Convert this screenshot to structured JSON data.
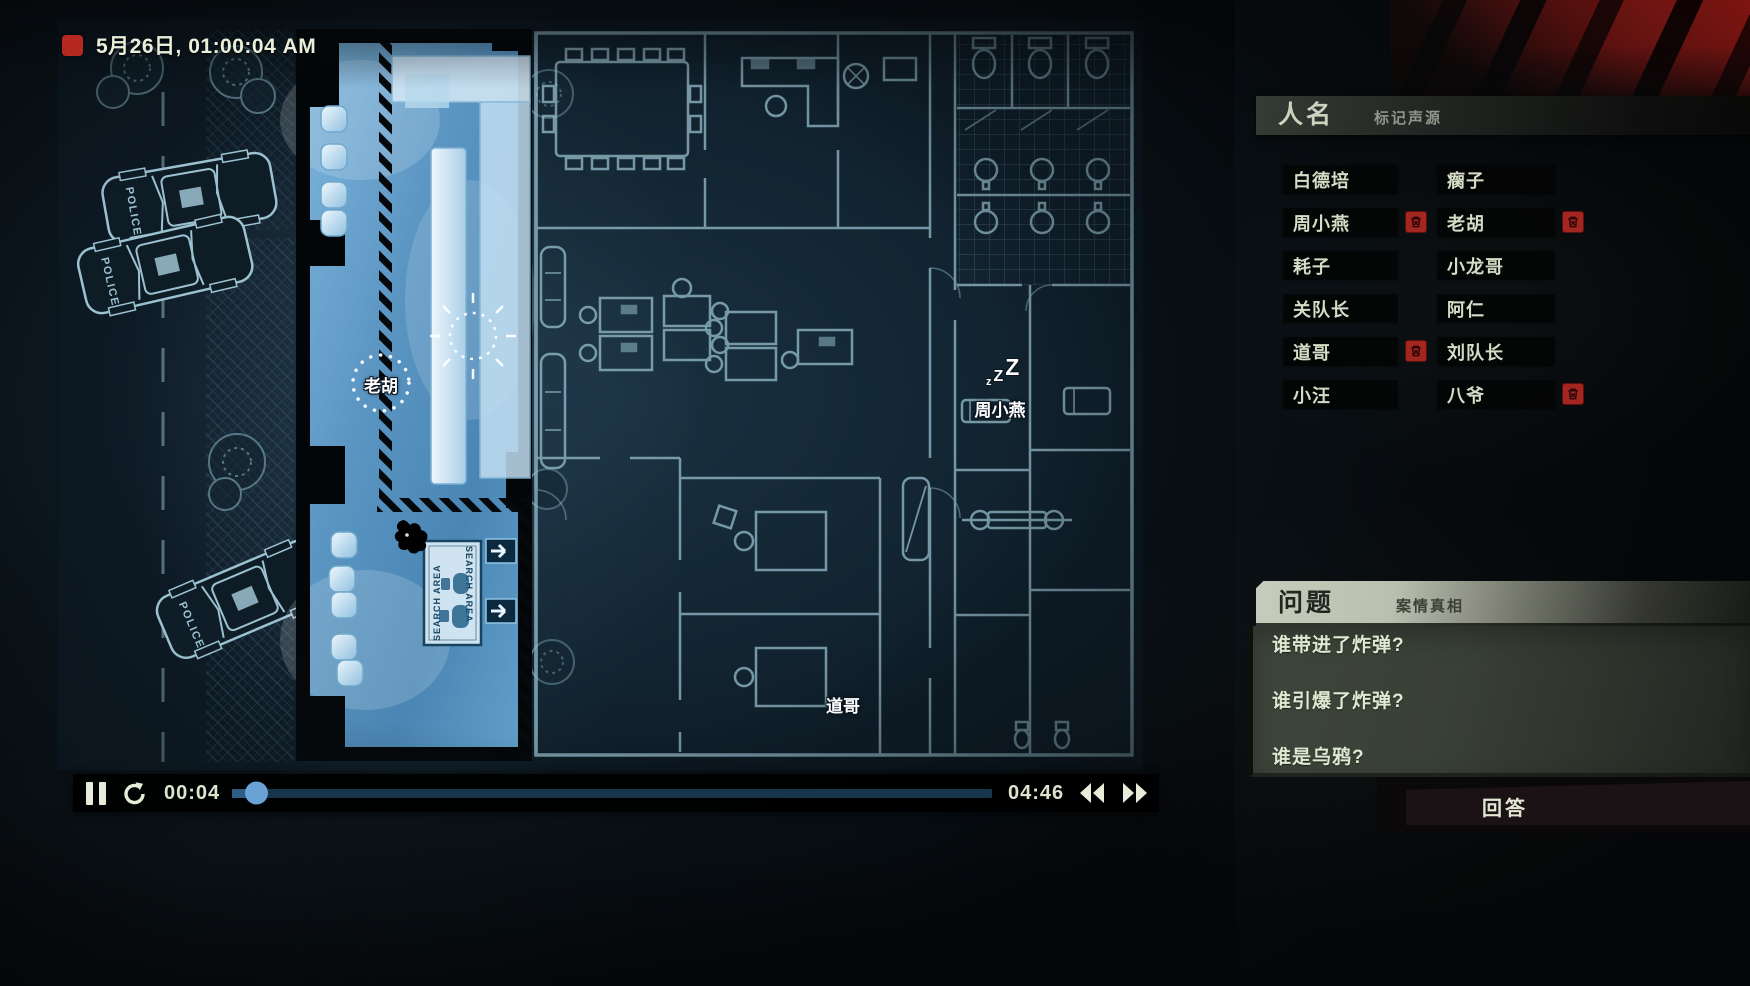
{
  "recording": {
    "datetime": "5月26日, 01:00:04 AM"
  },
  "map": {
    "police_label": "POLICE",
    "search_area_label": "SEARCH AREA",
    "characters": [
      {
        "name": "老胡",
        "marker": "dotted-circle"
      },
      {
        "name": "周小燕",
        "status": "sleeping",
        "sleep_glyphs": [
          "z",
          "Z",
          "Z"
        ]
      },
      {
        "name": "道哥"
      }
    ]
  },
  "names_panel": {
    "title": "人名",
    "subtitle": "标记声源",
    "names": [
      {
        "label": "白德培",
        "deletable": false
      },
      {
        "label": "瘸子",
        "deletable": false
      },
      {
        "label": "周小燕",
        "deletable": true
      },
      {
        "label": "老胡",
        "deletable": true
      },
      {
        "label": "耗子",
        "deletable": false
      },
      {
        "label": "小龙哥",
        "deletable": false
      },
      {
        "label": "关队长",
        "deletable": false
      },
      {
        "label": "阿仁",
        "deletable": false
      },
      {
        "label": "道哥",
        "deletable": true
      },
      {
        "label": "刘队长",
        "deletable": false
      },
      {
        "label": "小汪",
        "deletable": false
      },
      {
        "label": "八爷",
        "deletable": true
      }
    ]
  },
  "questions_panel": {
    "title": "问题",
    "subtitle": "案情真相",
    "questions": [
      "谁带进了炸弹?",
      "谁引爆了炸弹?",
      "谁是乌鸦?"
    ],
    "answer_button_label": "回答"
  },
  "player": {
    "elapsed": "00:04",
    "duration": "04:46",
    "progress_percent": 2.3
  },
  "colors": {
    "record_red": "#b5281f",
    "delete_red": "#a32621",
    "progress_blue": "#6ba2d6",
    "highlight_room_blue": "#5e9cc8",
    "blueprint_line": "#8fb6c4",
    "stripe_red": "#7e1511",
    "question_text": "#dcead2"
  }
}
